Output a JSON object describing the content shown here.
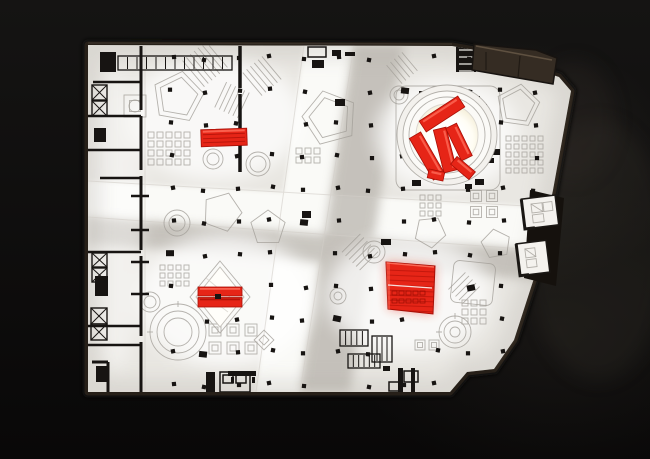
{
  "colors": {
    "bg": "#0c0b0a",
    "rim": "#261f18",
    "rimDark": "#15110d",
    "rimLight": "#5d5040",
    "surface": "#e9e7e2",
    "street": "#fafaf7",
    "shadowBand": "#b9b5ae",
    "line": "#a39f98",
    "black": "#171412",
    "red": "#e62517",
    "redDark": "#a80f06",
    "redLight": "#ff6f5c",
    "glowWarm": "#f6edd2",
    "voidWhite": "#fffefa"
  },
  "scene": {
    "outline": "88,45 452,46 480,51 559,77 571,91 553,190 536,272 514,340 494,369 467,372 450,392 88,392",
    "vertical_street": "304,45 354,45 300,392 256,392",
    "horizontal_street": "88,181 578,209 578,253 88,217",
    "vertical_shadow": "354,45 404,45 350,392 300,392",
    "horizontal_shadow": "88,217 578,253 578,283 88,244",
    "columns": {
      "x0": 106,
      "dx": 33,
      "nx": 14,
      "y0": 58,
      "dy": 32.7,
      "ny": 11,
      "size": 4.2
    },
    "red_elements": {
      "top_left_bar": {
        "x": 201,
        "y": 129,
        "w": 46,
        "h": 17,
        "rot": -2
      },
      "circle_installation": {
        "cx": 447,
        "cy": 135,
        "outer_r": 50,
        "mid_r": 44,
        "ring_r": 38,
        "inner_r": 31,
        "bars": [
          [
            442,
            114,
            46,
            13,
            -33
          ],
          [
            427,
            156,
            48,
            13,
            60
          ],
          [
            445,
            150,
            44,
            13,
            76
          ],
          [
            459,
            142,
            36,
            12,
            64
          ],
          [
            463,
            168,
            24,
            10,
            40
          ],
          [
            436,
            175,
            16,
            9,
            12
          ]
        ]
      },
      "diamond_installation": {
        "points": "220,267 244,297 220,327 196,297",
        "bars": [
          [
            198,
            287,
            44,
            9
          ],
          [
            198,
            297.5,
            44,
            9.5
          ]
        ]
      },
      "bottom_right_panel": {
        "points": "386,262 435,266 433,314 388,309"
      }
    },
    "linework": {
      "pentagons": [
        [
          178,
          97,
          26,
          10
        ],
        [
          178,
          97,
          20,
          10
        ],
        [
          330,
          118,
          28,
          -15
        ],
        [
          330,
          118,
          21,
          -15
        ],
        [
          518,
          106,
          22,
          8
        ],
        [
          518,
          106,
          17,
          8
        ],
        [
          222,
          212,
          20,
          20
        ],
        [
          268,
          228,
          18,
          0
        ],
        [
          430,
          232,
          16,
          30
        ],
        [
          496,
          244,
          15,
          -10
        ]
      ],
      "donuts": [
        [
          213,
          159,
          10,
          6
        ],
        [
          258,
          164,
          12,
          8
        ],
        [
          177,
          223,
          13,
          8
        ],
        [
          399,
          95,
          9,
          5
        ],
        [
          150,
          302,
          10,
          6
        ],
        [
          338,
          296,
          8,
          4
        ],
        [
          374,
          252,
          11,
          6
        ],
        [
          135,
          106,
          6,
          0
        ]
      ],
      "targets": [
        [
          455,
          332,
          16,
          11,
          5
        ],
        [
          178,
          332,
          28,
          21,
          14
        ]
      ],
      "grids": [
        [
          148,
          132,
          5,
          4,
          6,
          3
        ],
        [
          506,
          136,
          5,
          5,
          5,
          3
        ],
        [
          420,
          195,
          3,
          3,
          5,
          3
        ],
        [
          160,
          265,
          4,
          3,
          5,
          3
        ],
        [
          296,
          148,
          3,
          2,
          6,
          3
        ],
        [
          462,
          300,
          3,
          3,
          6,
          3
        ]
      ],
      "brackets": [
        [
          215,
          330,
          12,
          0
        ],
        [
          233,
          330,
          12,
          0
        ],
        [
          251,
          330,
          12,
          0
        ],
        [
          215,
          348,
          12,
          0
        ],
        [
          233,
          348,
          12,
          0
        ],
        [
          251,
          348,
          12,
          0
        ],
        [
          476,
          196,
          11,
          0
        ],
        [
          492,
          196,
          11,
          0
        ],
        [
          476,
          212,
          11,
          0
        ],
        [
          492,
          212,
          11,
          0
        ],
        [
          420,
          345,
          10,
          0
        ],
        [
          434,
          345,
          10,
          0
        ],
        [
          264,
          340,
          14,
          45
        ],
        [
          135,
          106,
          22,
          0
        ]
      ],
      "hatches": [
        [
          205,
          64,
          -40,
          7,
          34,
          5
        ],
        [
          262,
          76,
          -40,
          6,
          30,
          5
        ],
        [
          232,
          100,
          25,
          6,
          28,
          5
        ],
        [
          402,
          68,
          -40,
          5,
          24,
          5
        ],
        [
          360,
          252,
          45,
          6,
          26,
          5
        ],
        [
          464,
          288,
          45,
          5,
          24,
          5
        ]
      ],
      "racks": [
        [
          118,
          56,
          114,
          14,
          11
        ],
        [
          340,
          330,
          28,
          16,
          4
        ],
        [
          348,
          354,
          32,
          14,
          5
        ],
        [
          372,
          336,
          20,
          26,
          3
        ]
      ],
      "rounded_squares": [
        [
          396,
          86,
          104,
          0,
          10
        ],
        [
          452,
          262,
          42,
          6,
          6
        ]
      ]
    },
    "walls": {
      "segments": [
        [
          141,
          46,
          141,
          110,
          3
        ],
        [
          141,
          116,
          141,
          170,
          3
        ],
        [
          141,
          176,
          141,
          250,
          3
        ],
        [
          141,
          256,
          141,
          336,
          3
        ],
        [
          141,
          342,
          141,
          392,
          3
        ],
        [
          240,
          46,
          240,
          88,
          3.5
        ],
        [
          240,
          94,
          240,
          138,
          3.5
        ],
        [
          240,
          144,
          240,
          172,
          3.5
        ],
        [
          93,
          82,
          141,
          82,
          2.5
        ],
        [
          88,
          116,
          141,
          116,
          2.5
        ],
        [
          88,
          150,
          141,
          150,
          2.5
        ],
        [
          100,
          178,
          141,
          178,
          2.5
        ],
        [
          131,
          196,
          149,
          196,
          2.5
        ],
        [
          131,
          230,
          149,
          230,
          2.5
        ],
        [
          88,
          252,
          141,
          252,
          2.5
        ],
        [
          131,
          262,
          149,
          262,
          2.5
        ],
        [
          131,
          294,
          149,
          294,
          2.5
        ],
        [
          88,
          326,
          141,
          326,
          2.5
        ],
        [
          88,
          345,
          141,
          345,
          2.5
        ],
        [
          92,
          362,
          108,
          362,
          3
        ],
        [
          108,
          362,
          108,
          392,
          3
        ]
      ],
      "blocks": [
        [
          100,
          52,
          16,
          20
        ],
        [
          94,
          128,
          12,
          14
        ],
        [
          95,
          276,
          13,
          20
        ],
        [
          96,
          366,
          11,
          16
        ],
        [
          206,
          372,
          9,
          20
        ],
        [
          312,
          60,
          12,
          8
        ],
        [
          332,
          50,
          9,
          6
        ],
        [
          345,
          52,
          10,
          4
        ],
        [
          228,
          371,
          28,
          5
        ],
        [
          231,
          377,
          3,
          6
        ],
        [
          252,
          377,
          3,
          6
        ],
        [
          398,
          368,
          5,
          25
        ],
        [
          411,
          368,
          4,
          25
        ],
        [
          383,
          366,
          7,
          5
        ],
        [
          456,
          44,
          20,
          28
        ],
        [
          470,
          96,
          10,
          7
        ],
        [
          479,
          104,
          8,
          5
        ],
        [
          491,
          149,
          9,
          6
        ],
        [
          487,
          158,
          7,
          5
        ],
        [
          475,
          179,
          9,
          6
        ],
        [
          465,
          184,
          7,
          5
        ],
        [
          419,
          91,
          8,
          5
        ],
        [
          412,
          180,
          9,
          6
        ],
        [
          302,
          211,
          9,
          7
        ],
        [
          335,
          99,
          10,
          7
        ],
        [
          381,
          239,
          10,
          6
        ]
      ],
      "xboxes": [
        [
          92,
          85,
          15,
          15
        ],
        [
          92,
          101,
          15,
          15
        ],
        [
          92,
          253,
          15,
          14
        ],
        [
          92,
          268,
          15,
          14
        ],
        [
          91,
          308,
          16,
          16
        ],
        [
          91,
          324,
          16,
          16
        ]
      ],
      "outline_boxes": [
        [
          308,
          47,
          18,
          10
        ],
        [
          404,
          371,
          14,
          11
        ],
        [
          389,
          382,
          10,
          9
        ],
        [
          220,
          372,
          30,
          20
        ],
        [
          223,
          375,
          10,
          8
        ],
        [
          236,
          375,
          10,
          8
        ]
      ],
      "light_lines": [
        [
          459,
          50,
          474,
          50
        ],
        [
          459,
          57,
          474,
          57
        ],
        [
          459,
          64,
          474,
          64
        ],
        [
          459,
          71,
          474,
          71
        ]
      ]
    }
  }
}
